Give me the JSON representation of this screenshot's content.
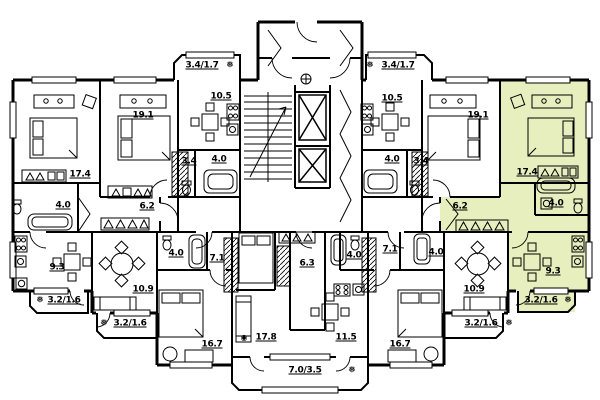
{
  "plan": {
    "type": "residential floor plan",
    "background_color": "#ffffff",
    "line_color": "#000000",
    "highlight_color": "#e6efbd"
  },
  "icons": {
    "snowflake": "❅",
    "drain": "◉"
  },
  "highlighted_apartment": {
    "room_areas": [
      "17.4",
      "4.0",
      "6.2",
      "9.3",
      "3.2/1.6"
    ]
  },
  "room_labels": [
    {
      "text": "3.4/1.7",
      "highlighted": false
    },
    {
      "text": "10.5",
      "highlighted": false
    },
    {
      "text": "19.1",
      "highlighted": false
    },
    {
      "text": "17.4",
      "highlighted": false
    },
    {
      "text": "3.4",
      "highlighted": false
    },
    {
      "text": "4.0",
      "highlighted": false
    },
    {
      "text": "4.0",
      "highlighted": false
    },
    {
      "text": "6.2",
      "highlighted": false
    },
    {
      "text": "9.3",
      "highlighted": false
    },
    {
      "text": "3.2/1.6",
      "highlighted": false
    },
    {
      "text": "10.9",
      "highlighted": false
    },
    {
      "text": "3.2/1.6",
      "highlighted": false
    },
    {
      "text": "4.0",
      "highlighted": false
    },
    {
      "text": "7.1",
      "highlighted": false
    },
    {
      "text": "16.7",
      "highlighted": false
    },
    {
      "text": "17.8",
      "highlighted": false
    },
    {
      "text": "11.5",
      "highlighted": false
    },
    {
      "text": "7.0/3.5",
      "highlighted": false
    },
    {
      "text": "6.3",
      "highlighted": false
    },
    {
      "text": "3.4/1.7",
      "highlighted": false
    },
    {
      "text": "10.5",
      "highlighted": false
    },
    {
      "text": "19.1",
      "highlighted": false
    },
    {
      "text": "17.4",
      "highlighted": true
    },
    {
      "text": "4.0",
      "highlighted": false
    },
    {
      "text": "3.4",
      "highlighted": false
    },
    {
      "text": "4.0",
      "highlighted": true
    },
    {
      "text": "6.2",
      "highlighted": true
    },
    {
      "text": "9.3",
      "highlighted": true
    },
    {
      "text": "3.2/1.6",
      "highlighted": true
    },
    {
      "text": "10.9",
      "highlighted": false
    },
    {
      "text": "3.2/1.6",
      "highlighted": false
    },
    {
      "text": "4.0",
      "highlighted": false
    },
    {
      "text": "7.1",
      "highlighted": false
    },
    {
      "text": "4.0",
      "highlighted": false
    },
    {
      "text": "16.7",
      "highlighted": false
    }
  ]
}
